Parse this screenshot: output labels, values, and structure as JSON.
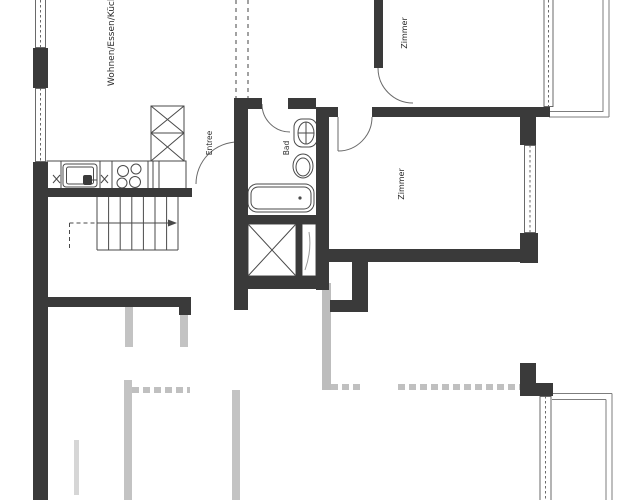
{
  "plan": {
    "type": "apartment-floor-plan",
    "rooms": [
      {
        "id": "living",
        "label": "Wohnen/Essen/Küche"
      },
      {
        "id": "zimmer-top",
        "label": "Zimmer"
      },
      {
        "id": "zimmer-mid",
        "label": "Zimmer"
      },
      {
        "id": "bad",
        "label": "Bad"
      },
      {
        "id": "entree",
        "label": "Entree"
      }
    ],
    "fixtures": [
      "kitchen-sink",
      "stove",
      "tall-cabinet",
      "counter",
      "bathtub",
      "toilet",
      "washbasin",
      "closet",
      "staircase"
    ],
    "colors": {
      "wall": "#3a3a3a",
      "thin_line": "#4a4a4a",
      "light_line": "#8a8a8a",
      "neighbor_wall": "#bdbdbd",
      "background": "#ffffff"
    }
  }
}
